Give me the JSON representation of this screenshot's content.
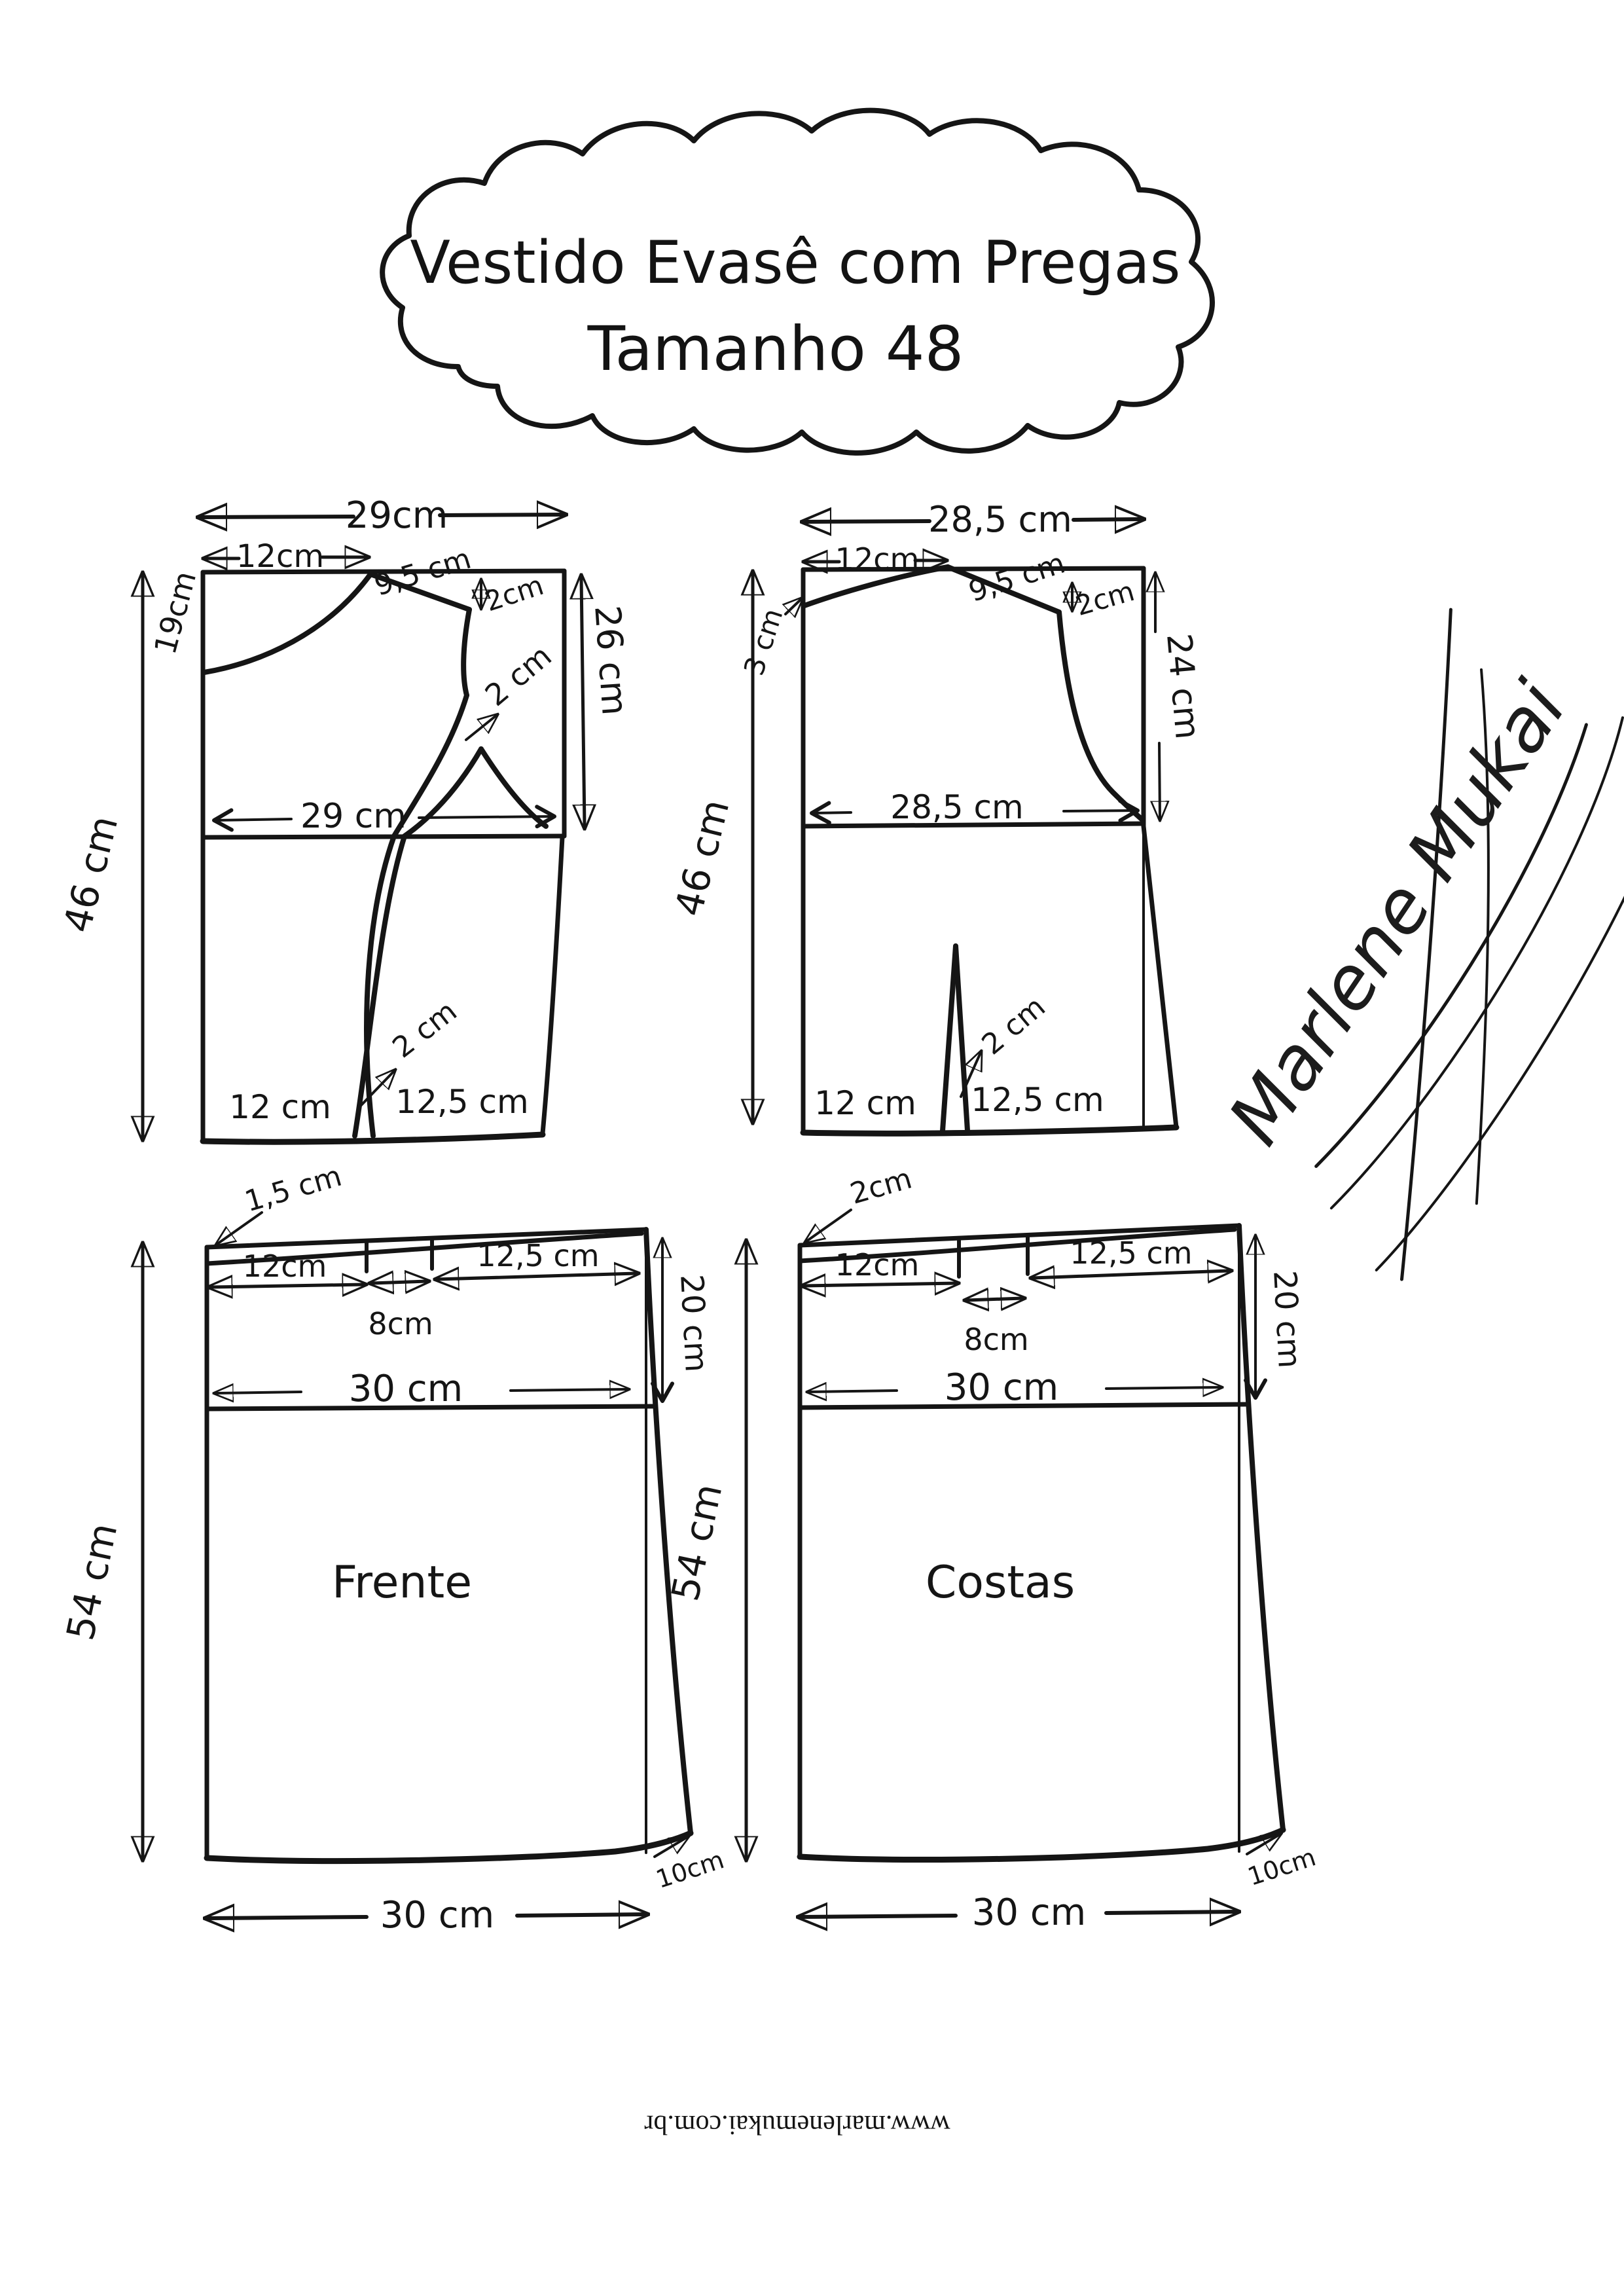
{
  "page": {
    "background": "#ffffff",
    "ink": "#151515"
  },
  "title": {
    "line1": "Vestido Evasê com Pregas",
    "line2": "Tamanho 48"
  },
  "signature": "Marlene Mukai",
  "website": "www.marlenemukai.com.br",
  "bodice_front": {
    "top_width": "29cm",
    "neck_width": "12cm",
    "shoulder": "9,5 cm",
    "shoulder_drop": "2cm",
    "neck_depth": "19cm",
    "side_length": "26 cm",
    "height": "46 cm",
    "waist_width": "29 cm",
    "armhole_dart": "2 cm",
    "hem_seg_left": "12 cm",
    "hem_seg_right": "12,5 cm",
    "hem_dart": "2 cm"
  },
  "bodice_back": {
    "top_width": "28,5 cm",
    "neck_width": "12cm",
    "neck_depth": "3 cm",
    "shoulder": "9,5 cm",
    "shoulder_drop": "2cm",
    "side_length": "24 cm",
    "height": "46 cm",
    "waist_width": "28,5 cm",
    "hem_seg_left": "12 cm",
    "hem_seg_right": "12,5 cm",
    "hem_dart": "2 cm"
  },
  "skirt_front": {
    "label": "Frente",
    "side_rise": "1,5 cm",
    "seg1": "12cm",
    "pleat_width": "8cm",
    "seg2": "12,5 cm",
    "hip_width": "30 cm",
    "hip_drop": "20 cm",
    "length": "54 cm",
    "hem_flare": "10cm",
    "hem_width": "30 cm"
  },
  "skirt_back": {
    "label": "Costas",
    "side_rise": "2cm",
    "seg1": "12cm",
    "pleat_width": "8cm",
    "seg2": "12,5 cm",
    "hip_width": "30 cm",
    "hip_drop": "20 cm",
    "length": "54 cm",
    "hem_flare": "10cm",
    "hem_width": "30 cm"
  }
}
